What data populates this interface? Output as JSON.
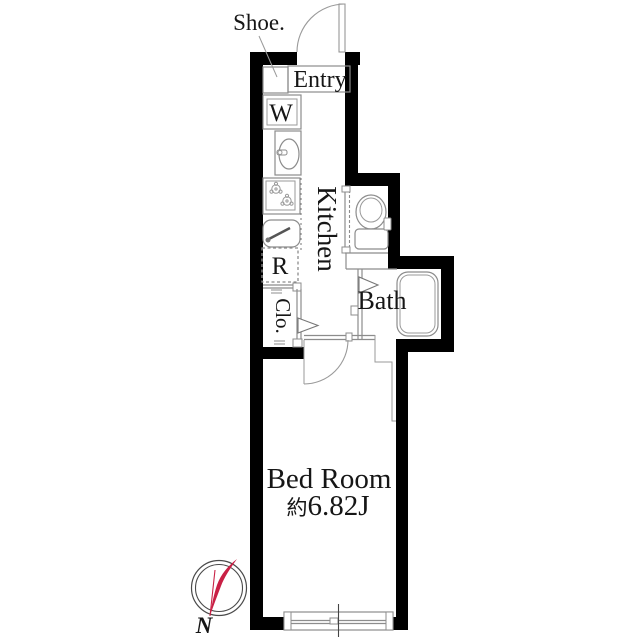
{
  "floorplan": {
    "labels": {
      "shoe": "Shoe.",
      "entry": "Entry",
      "washer": "W",
      "kitchen": "Kitchen",
      "refrigerator": "R",
      "closet": "Clo.",
      "bath": "Bath",
      "bedroom": "Bed Room",
      "bedroom_area_prefix": "約",
      "bedroom_area": "6.82J",
      "north": "N"
    },
    "colors": {
      "wall": "#000000",
      "line": "#8c8c8c",
      "text": "#161616",
      "compass_needle": "#c92045"
    }
  }
}
